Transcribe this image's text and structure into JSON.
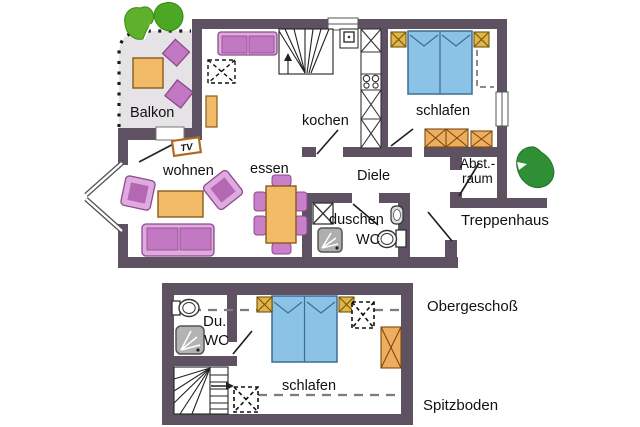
{
  "plan_title": "Ferienwohnung Grundriss",
  "colors": {
    "wall": "#5d5162",
    "furniture_orange": "#f2bb67",
    "furniture_orange_stroke": "#8a5a1c",
    "furniture_gold": "#e2b546",
    "furniture_purple_light": "#dfaade",
    "furniture_purple_mid": "#c278c2",
    "furniture_purple_stroke": "#8c4a8c",
    "bed_blue": "#8bc3e7",
    "bed_blue_stroke": "#3e6c91",
    "balcony_gray": "#e5e3e5",
    "shower_gray": "#aeaeae",
    "tree_green_light": "#5fb02b",
    "tree_green_dark": "#2e8f35"
  },
  "upper_floor": {
    "name_label": "Obergeschoß",
    "rooms": {
      "balcony": "Balkon",
      "living": "wohnen",
      "dining": "essen",
      "kitchen": "kochen",
      "bedroom": "schlafen",
      "hall": "Diele",
      "shower_room": "duschen",
      "wc": "WC",
      "storage_line1": "Abst.-",
      "storage_line2": "raum",
      "stairwell": "Treppenhaus"
    },
    "tv_label": "TV",
    "furniture": [
      "sofa",
      "armchair",
      "coffee-table",
      "dining-table",
      "dining-chair",
      "tv",
      "shelf",
      "staircase",
      "kitchen-cabinet",
      "stove",
      "sink",
      "double-bed",
      "nightstand",
      "wardrobe",
      "washbasin",
      "shower",
      "toilet",
      "balcony-table",
      "balcony-chair",
      "tree"
    ]
  },
  "attic_floor": {
    "name_label": "Spitzboden",
    "rooms": {
      "shower_line1": "Du.",
      "shower_line2": "WC",
      "bedroom": "schlafen"
    },
    "furniture": [
      "double-bed",
      "nightstand",
      "wardrobe",
      "roof-window",
      "toilet",
      "shower",
      "staircase",
      "height-line"
    ]
  }
}
